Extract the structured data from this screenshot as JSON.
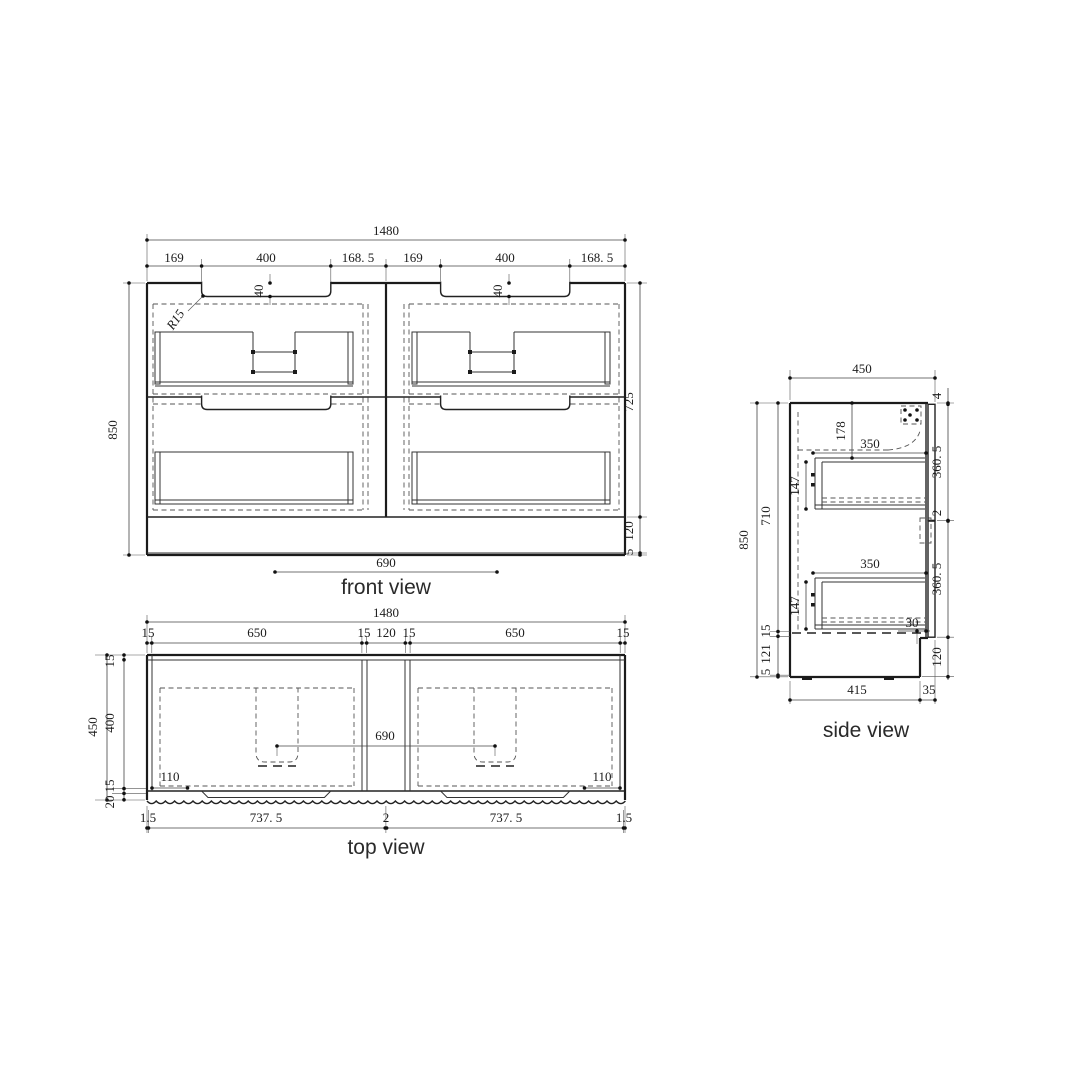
{
  "front": {
    "label": "front view",
    "d1480": "1480",
    "d169": "169",
    "d400": "400",
    "d168_5": "168. 5",
    "d40": "40",
    "r15": "R15",
    "d850": "850",
    "d725": "725",
    "d120": "120",
    "d5": "5",
    "d690": "690"
  },
  "top": {
    "label": "top view",
    "d1480": "1480",
    "d15": "15",
    "d650": "650",
    "d120": "120",
    "d450": "450",
    "d400": "400",
    "d20": "20",
    "d1_5": "1.5",
    "d737_5": "737. 5",
    "d2": "2",
    "d690": "690",
    "d110": "110"
  },
  "side": {
    "label": "side view",
    "d450": "450",
    "d4": "4",
    "d360_5": "360. 5",
    "d2": "2",
    "d120": "120",
    "d850": "850",
    "d710": "710",
    "d15": "15",
    "d121": "121",
    "d5": "5",
    "d178": "178",
    "d350": "350",
    "d147": "147",
    "d30": "30",
    "d415": "415",
    "d35": "35"
  }
}
